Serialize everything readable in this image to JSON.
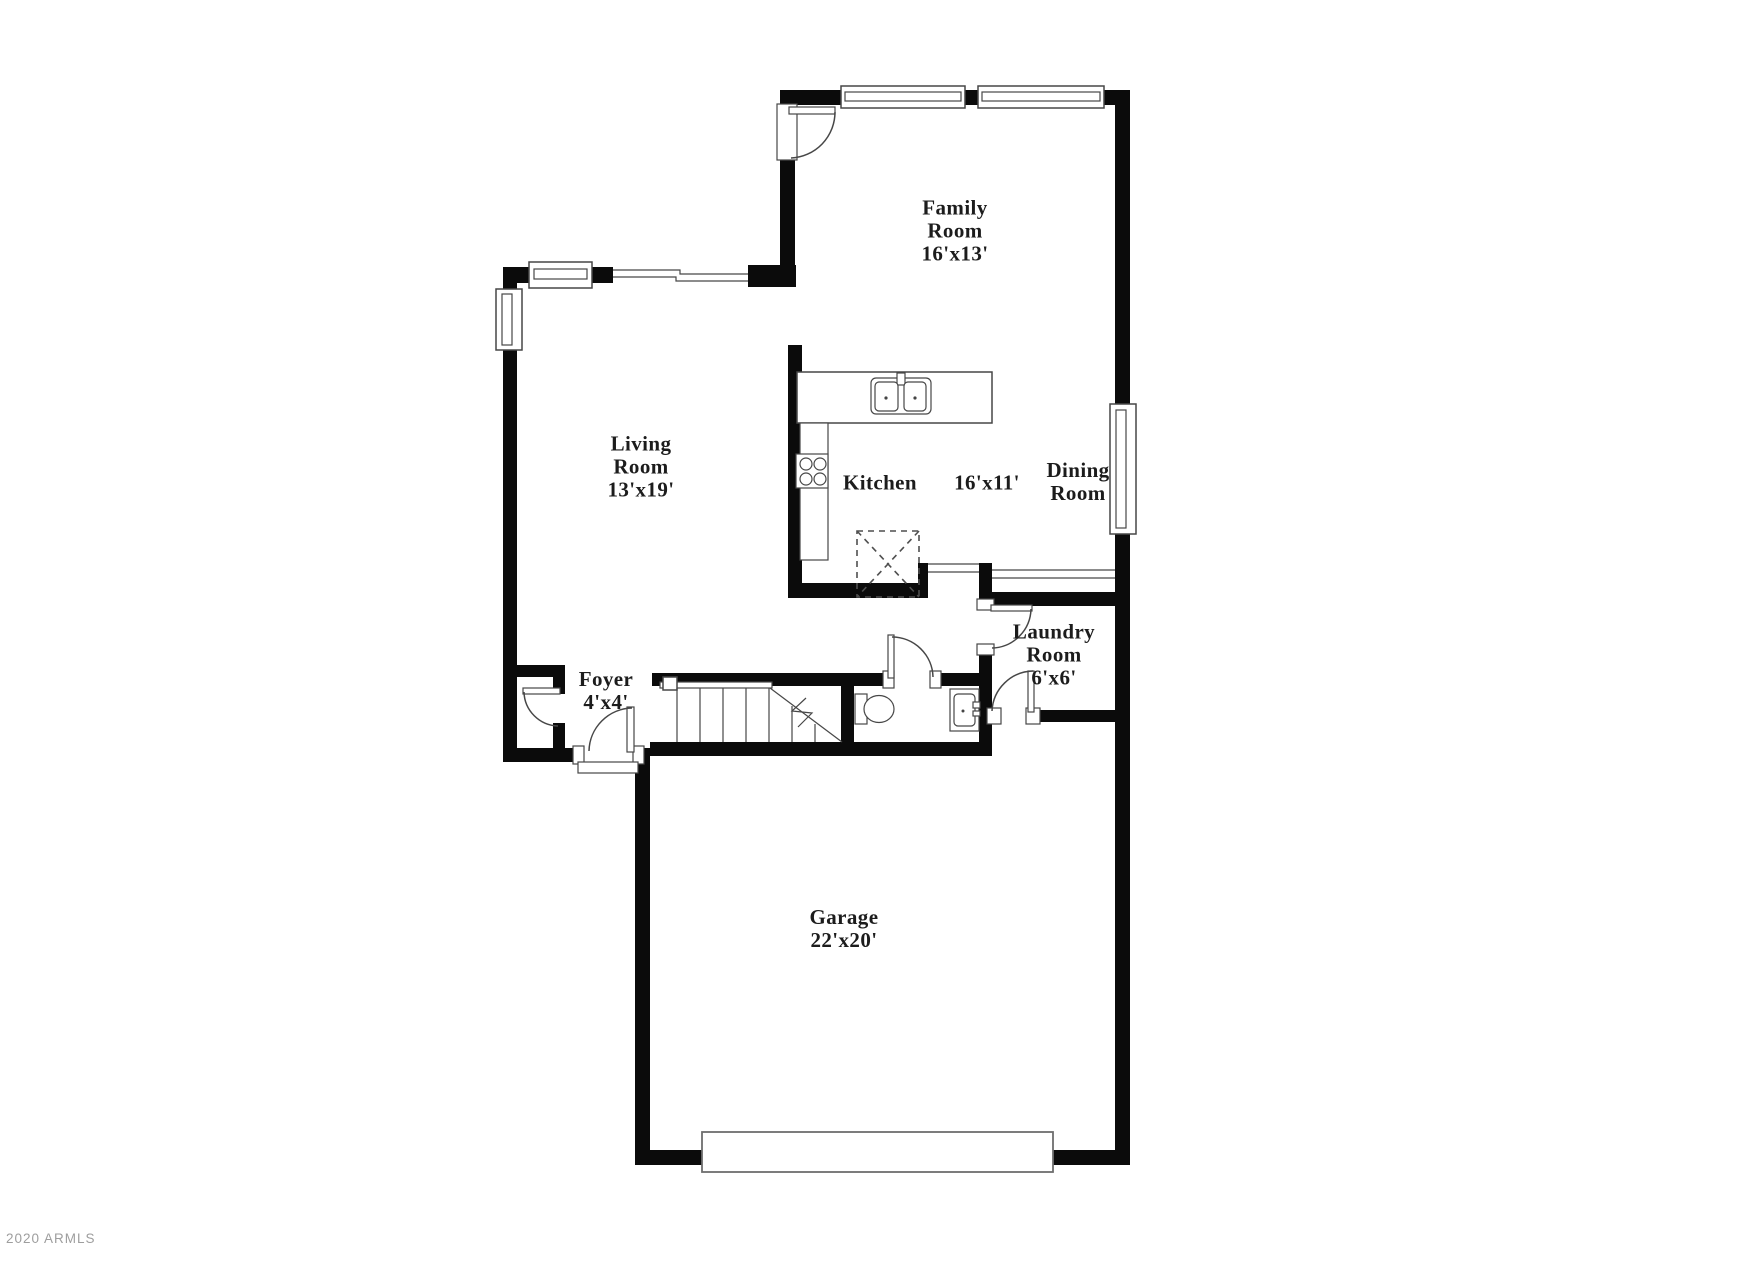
{
  "watermark": "2020 ARMLS",
  "colors": {
    "background": "#ffffff",
    "wall": "#0b0b0b",
    "line": "#474747",
    "label": "#1c1c1c",
    "watermark": "#9e9e9e"
  },
  "rooms": {
    "family": {
      "name": "Family Room",
      "dims": "16'x13'"
    },
    "living": {
      "name": "Living Room",
      "dims": "13'x19'"
    },
    "kitchen": {
      "name": "Kitchen",
      "dims": "16'x11'"
    },
    "dining": {
      "name": "Dining Room"
    },
    "laundry": {
      "name": "Laundry Room",
      "dims": "6'x6'"
    },
    "foyer": {
      "name": "Foyer",
      "dims": "4'x4'"
    },
    "garage": {
      "name": "Garage",
      "dims": "22'x20'"
    }
  }
}
